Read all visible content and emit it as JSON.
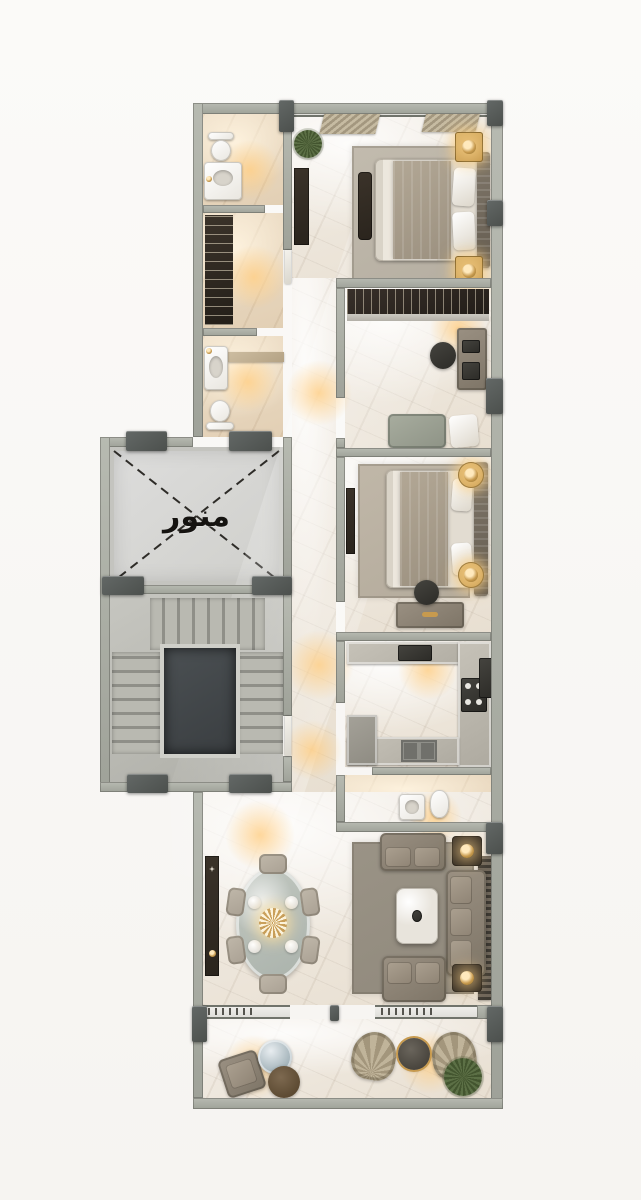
{
  "canvas": {
    "width": 641,
    "height": 1200,
    "background": "#f8f6f3"
  },
  "plan": {
    "light_well_label": "منور",
    "colors": {
      "wall": "#b7bab1",
      "wall_dark": "#9fa299",
      "column": "#4c504d",
      "column_hi": "#636866",
      "floor": "#f3eee7",
      "floor_warm": "#eedfc9",
      "lightwell": "#cfcfcb",
      "concrete": "#c6c6c0",
      "tread": "#b9b9b1",
      "void": "#3a3e41",
      "wood_dark": "#2a241d",
      "gold": "#c79a4e",
      "fixture": "#e9e6df",
      "sofa": "#7e7567",
      "sofa_hi": "#9a9082",
      "counter": "#aeaaa0",
      "chair": "#a9a093",
      "glass": "#aab2ab",
      "blanket": "#9c9180",
      "plant": "#5c7046",
      "rug_master": "#b6afa2",
      "rug_bedroom": "#b4ab9c",
      "rug_living": "#90897c"
    },
    "rooms": [
      {
        "id": "master-bedroom"
      },
      {
        "id": "bathroom-1"
      },
      {
        "id": "dressing-corridor"
      },
      {
        "id": "bathroom-2"
      },
      {
        "id": "light-well"
      },
      {
        "id": "staircase"
      },
      {
        "id": "office-bedroom"
      },
      {
        "id": "second-bedroom"
      },
      {
        "id": "kitchen"
      },
      {
        "id": "guest-toilet"
      },
      {
        "id": "living-room"
      },
      {
        "id": "dining-area"
      },
      {
        "id": "balcony"
      }
    ]
  }
}
